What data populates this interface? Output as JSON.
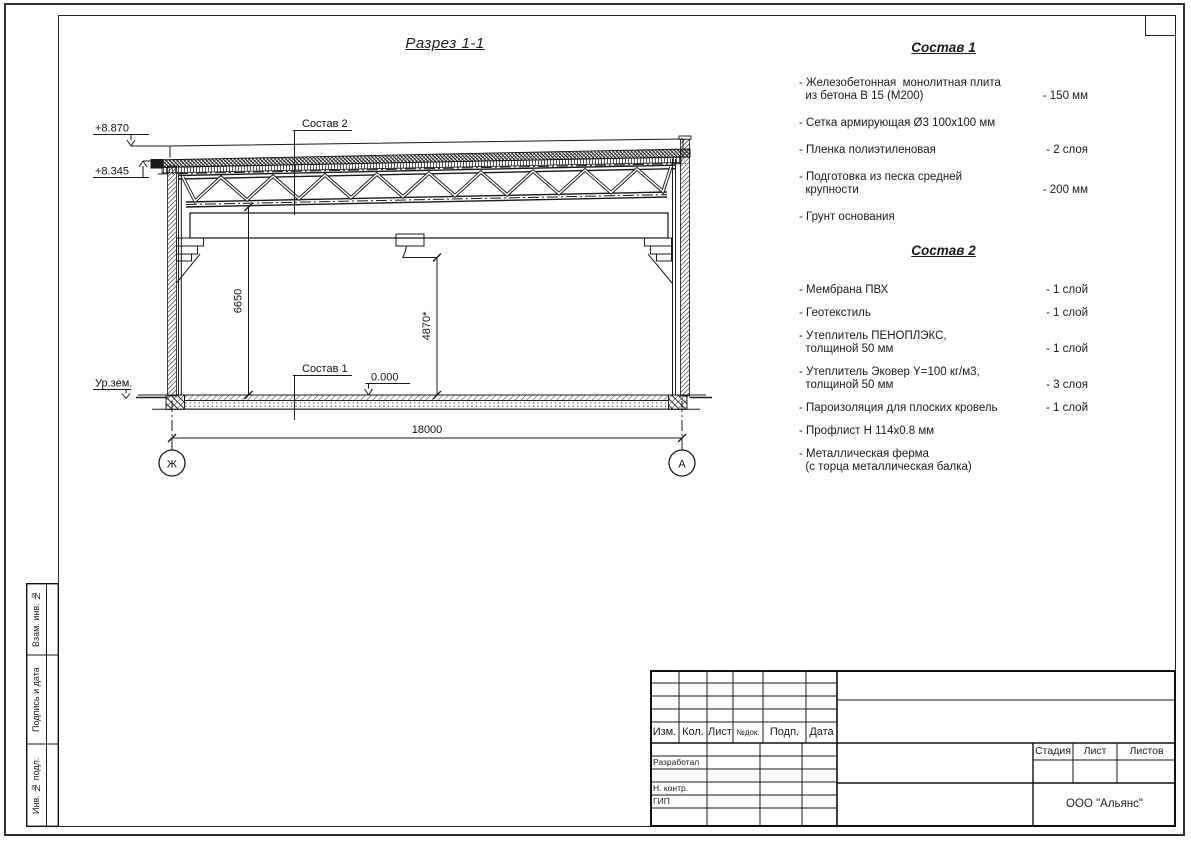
{
  "drawing": {
    "title": "Разрез 1-1",
    "callout_roof": "Состав 2",
    "callout_floor": "Состав 1",
    "elev_parapet": "+8.870",
    "elev_eaves": "+8.345",
    "elev_zero": "0.000",
    "ground_label": "Ур.зем.",
    "dim_height_truss": "6650",
    "dim_height_clear": "4870*",
    "dim_span": "18000",
    "axis_left": "Ж",
    "axis_right": "А"
  },
  "sostav1": {
    "heading": "Состав 1",
    "items": [
      {
        "name": "- Железобетонная  монолитная плита\n  из бетона В 15 (М200)",
        "value": "- 150 мм"
      },
      {
        "name": "- Сетка армирующая Ø3 100х100 мм",
        "value": ""
      },
      {
        "name": "- Пленка полиэтиленовая",
        "value": "- 2 слоя"
      },
      {
        "name": "- Подготовка из песка средней\n  крупности",
        "value": "- 200 мм"
      },
      {
        "name": "- Грунт основания",
        "value": ""
      }
    ]
  },
  "sostav2": {
    "heading": "Состав 2",
    "items": [
      {
        "name": "- Мембрана ПВХ",
        "value": "- 1 слой"
      },
      {
        "name": "- Геотекстиль",
        "value": "- 1 слой"
      },
      {
        "name": "- Утеплитель ПЕНОПЛЭКС,\n  толщиной 50 мм",
        "value": "- 1 слой"
      },
      {
        "name": "- Утеплитель Эковер Y=100 кг/м3,\n  толщиной 50 мм",
        "value": "- 3 слоя"
      },
      {
        "name": "- Пароизоляция для плоских кровель",
        "value": "- 1 слой"
      },
      {
        "name": "- Профлист Н 114х0.8 мм",
        "value": ""
      },
      {
        "name": "- Металлическая ферма\n  (с торца металлическая балка)",
        "value": ""
      }
    ]
  },
  "titleblock": {
    "header_cols": [
      "Изм.",
      "Кол.",
      "Лист",
      "№док.",
      "Подп.",
      "Дата"
    ],
    "roles": [
      "Разработал",
      "Н. контр.",
      "ГИП"
    ],
    "stage_cols": [
      "Стадия",
      "Лист",
      "Листов"
    ],
    "company": "ООО \"Альянс\""
  },
  "margin_strip": {
    "cells": [
      "Взам. инв. №",
      "Подпись и дата",
      "Инв. № подл."
    ]
  }
}
